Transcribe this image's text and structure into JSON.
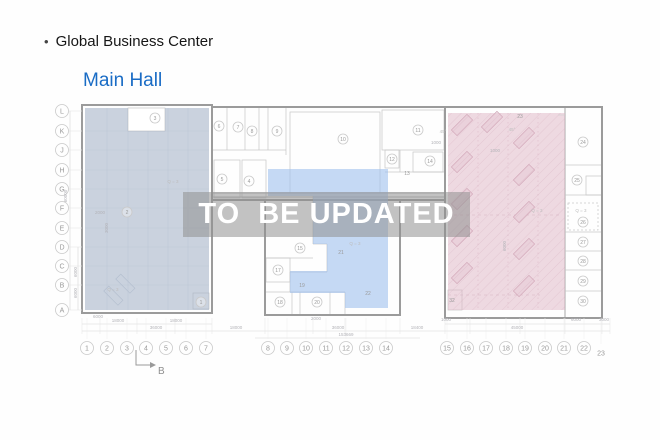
{
  "page": {
    "bullet": "•",
    "title": "Global Business Center",
    "hall": "Main Hall"
  },
  "watermark": {
    "text": "TO  BE UPDATED"
  },
  "colors": {
    "hall_title": "#1a6cc5",
    "zone_left_fill": "#c8d1dd",
    "zone_middle_fill": "#c4d8f3",
    "zone_right_fill": "#edd6df",
    "watermark_band": "rgba(143,143,143,0.55)",
    "watermark_text": "#ffffff",
    "wall": "#9b9b9b"
  },
  "plan": {
    "row_axis": [
      {
        "label": "L",
        "y": 111
      },
      {
        "label": "K",
        "y": 131
      },
      {
        "label": "J",
        "y": 150
      },
      {
        "label": "H",
        "y": 170
      },
      {
        "label": "G",
        "y": 189
      },
      {
        "label": "F",
        "y": 208
      },
      {
        "label": "E",
        "y": 228
      },
      {
        "label": "D",
        "y": 247
      },
      {
        "label": "C",
        "y": 266
      },
      {
        "label": "B",
        "y": 285
      },
      {
        "label": "A",
        "y": 310
      }
    ],
    "col_axis": [
      {
        "label": "1",
        "x": 87
      },
      {
        "label": "2",
        "x": 107
      },
      {
        "label": "3",
        "x": 127
      },
      {
        "label": "4",
        "x": 146
      },
      {
        "label": "5",
        "x": 166
      },
      {
        "label": "6",
        "x": 186
      },
      {
        "label": "7",
        "x": 206
      },
      {
        "label": "8",
        "x": 268
      },
      {
        "label": "9",
        "x": 287
      },
      {
        "label": "10",
        "x": 306
      },
      {
        "label": "11",
        "x": 326
      },
      {
        "label": "12",
        "x": 346
      },
      {
        "label": "13",
        "x": 366
      },
      {
        "label": "14",
        "x": 386
      },
      {
        "label": "15",
        "x": 447
      },
      {
        "label": "16",
        "x": 467
      },
      {
        "label": "17",
        "x": 486
      },
      {
        "label": "18",
        "x": 506
      },
      {
        "label": "19",
        "x": 525
      },
      {
        "label": "20",
        "x": 545
      },
      {
        "label": "21",
        "x": 564
      },
      {
        "label": "22",
        "x": 584
      },
      {
        "label": "23",
        "x": 601,
        "y": 353,
        "nc": true
      }
    ],
    "rooms": [
      {
        "n": "1",
        "x": 201,
        "y": 302
      },
      {
        "n": "2",
        "x": 127,
        "y": 212
      },
      {
        "n": "3",
        "x": 155,
        "y": 118
      },
      {
        "n": "4",
        "x": 249,
        "y": 181
      },
      {
        "n": "5",
        "x": 222,
        "y": 179
      },
      {
        "n": "6",
        "x": 219,
        "y": 126
      },
      {
        "n": "7",
        "x": 238,
        "y": 127
      },
      {
        "n": "8",
        "x": 252,
        "y": 131
      },
      {
        "n": "9",
        "x": 277,
        "y": 131
      },
      {
        "n": "10",
        "x": 343,
        "y": 139
      },
      {
        "n": "11",
        "x": 418,
        "y": 130
      },
      {
        "n": "12",
        "x": 392,
        "y": 159
      },
      {
        "n": "13",
        "x": 407,
        "y": 173,
        "nc": true
      },
      {
        "n": "14",
        "x": 430,
        "y": 161
      },
      {
        "n": "15",
        "x": 300,
        "y": 248
      },
      {
        "n": "17",
        "x": 278,
        "y": 270
      },
      {
        "n": "18",
        "x": 280,
        "y": 302
      },
      {
        "n": "19",
        "x": 302,
        "y": 285,
        "nc": true
      },
      {
        "n": "20",
        "x": 317,
        "y": 302
      },
      {
        "n": "21",
        "x": 341,
        "y": 252,
        "nc": true
      },
      {
        "n": "22",
        "x": 368,
        "y": 293,
        "nc": true
      },
      {
        "n": "23",
        "x": 520,
        "y": 116,
        "nc": true
      },
      {
        "n": "24",
        "x": 583,
        "y": 142
      },
      {
        "n": "25",
        "x": 577,
        "y": 180
      },
      {
        "n": "26",
        "x": 583,
        "y": 222
      },
      {
        "n": "27",
        "x": 583,
        "y": 242
      },
      {
        "n": "28",
        "x": 583,
        "y": 261
      },
      {
        "n": "29",
        "x": 583,
        "y": 281
      },
      {
        "n": "30",
        "x": 583,
        "y": 301
      },
      {
        "n": "32",
        "x": 452,
        "y": 300,
        "nc": true
      }
    ],
    "area_labels": [
      {
        "t": "Q = 3",
        "x": 173,
        "y": 183
      },
      {
        "t": "Q = 3",
        "x": 113,
        "y": 291
      },
      {
        "t": "Q = 3",
        "x": 355,
        "y": 245
      },
      {
        "t": "Q = 3",
        "x": 537,
        "y": 212
      },
      {
        "t": "Q = 3",
        "x": 581,
        "y": 212
      },
      {
        "t": "45°",
        "x": 443,
        "y": 133
      },
      {
        "t": "45°",
        "x": 512,
        "y": 131
      }
    ],
    "dims": [
      {
        "t": "60000",
        "x": 67,
        "y": 196,
        "r": -90
      },
      {
        "t": "6000",
        "x": 77,
        "y": 272,
        "r": -90
      },
      {
        "t": "6000",
        "x": 77,
        "y": 293,
        "r": -90
      },
      {
        "t": "2000",
        "x": 100,
        "y": 214
      },
      {
        "t": "3000",
        "x": 108,
        "y": 228,
        "r": -90
      },
      {
        "t": "1000",
        "x": 436,
        "y": 144
      },
      {
        "t": "1000",
        "x": 495,
        "y": 152
      },
      {
        "t": "6000",
        "x": 506,
        "y": 246,
        "r": -90
      },
      {
        "t": "6000",
        "x": 98,
        "y": 318
      },
      {
        "t": "18000",
        "x": 118,
        "y": 322
      },
      {
        "t": "18000",
        "x": 176,
        "y": 322
      },
      {
        "t": "36000",
        "x": 156,
        "y": 329
      },
      {
        "t": "18000",
        "x": 236,
        "y": 329
      },
      {
        "t": "2000",
        "x": 316,
        "y": 320
      },
      {
        "t": "36000",
        "x": 338,
        "y": 329
      },
      {
        "t": "153669",
        "x": 346,
        "y": 336
      },
      {
        "t": "18400",
        "x": 417,
        "y": 329
      },
      {
        "t": "1000",
        "x": 446,
        "y": 321
      },
      {
        "t": "45000",
        "x": 517,
        "y": 329
      },
      {
        "t": "6000",
        "x": 576,
        "y": 321
      },
      {
        "t": "3000",
        "x": 604,
        "y": 321
      }
    ],
    "section_marker": {
      "label": "B"
    }
  }
}
